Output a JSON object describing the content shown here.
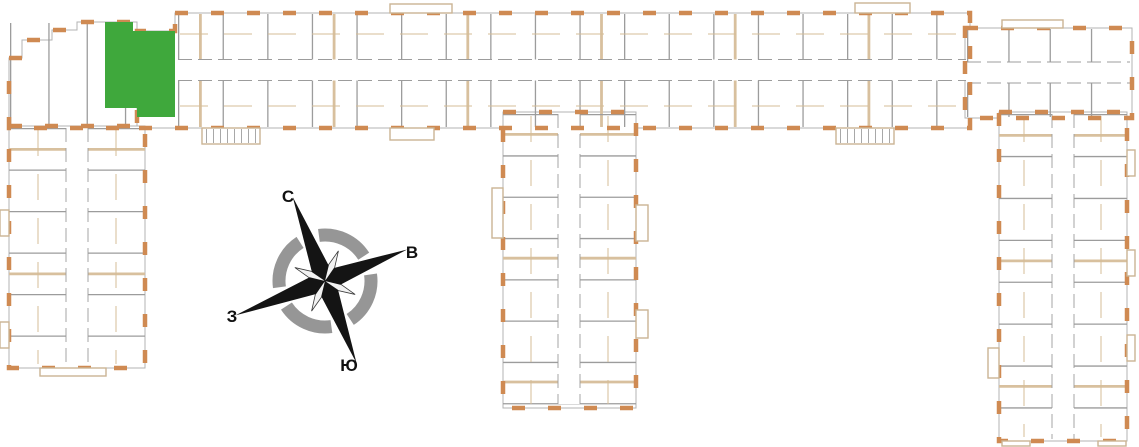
{
  "floorplan": {
    "kind": "building-floor-plan",
    "selected_apartment": {
      "fill": "#3fa83c",
      "status": "selected"
    },
    "colors": {
      "exterior_wall": "#cf8a52",
      "interior_wall": "#d8c09e",
      "partition_line": "#9c9c9c",
      "section_outline": "#b3b3b3",
      "background": "#ffffff"
    },
    "sections": [
      "left-wing",
      "top-strip",
      "center-wing",
      "right-block",
      "right-wing"
    ]
  },
  "compass": {
    "labels": {
      "north": "С",
      "east": "В",
      "west": "З",
      "south": "Ю"
    },
    "ring_color": "#969696",
    "needle_color": "#141414",
    "rotation_deg": -21
  }
}
